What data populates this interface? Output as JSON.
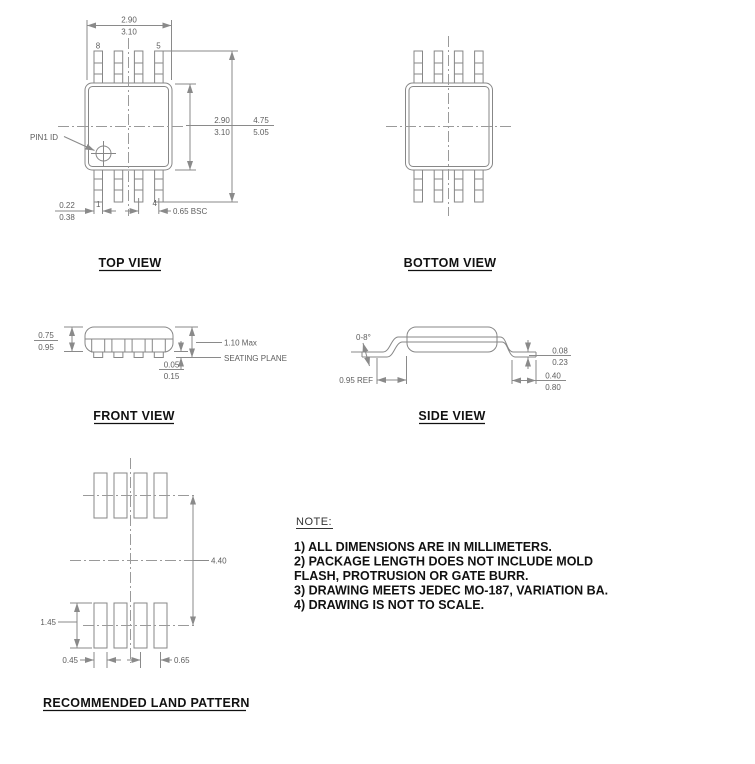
{
  "colors": {
    "line_gray": "#8a8a8a",
    "dim_text": "#5e5e5e",
    "ink": "#111111"
  },
  "top_view": {
    "title": "TOP VIEW",
    "pins": {
      "top_left": "8",
      "top_right": "5",
      "bottom_left": "1",
      "bottom_right": "4"
    },
    "pin1_id": "PIN1 ID",
    "width": {
      "upper": "2.90",
      "lower": "3.10"
    },
    "body_height": {
      "upper": "2.90",
      "lower": "3.10"
    },
    "overall_height": {
      "upper": "4.75",
      "lower": "5.05"
    },
    "lead_width": {
      "upper": "0.22",
      "lower": "0.38"
    },
    "pitch": "0.65 BSC"
  },
  "bottom_view": {
    "title": "BOTTOM VIEW"
  },
  "front_view": {
    "title": "FRONT VIEW",
    "thickness": {
      "upper": "0.75",
      "lower": "0.95"
    },
    "max_height": "1.10 Max",
    "seating_plane": "SEATING PLANE",
    "standoff": {
      "upper": "0.05",
      "lower": "0.15"
    }
  },
  "side_view": {
    "title": "SIDE VIEW",
    "lead_angle": "0-8°",
    "lead_thickness": {
      "upper": "0.08",
      "lower": "0.23"
    },
    "lead_length_ref": "0.95 REF",
    "foot_length": {
      "upper": "0.40",
      "lower": "0.80"
    }
  },
  "land_pattern": {
    "title": "RECOMMENDED LAND PATTERN",
    "row_span": "4.40",
    "pad_length": "1.45",
    "pad_width": "0.45",
    "pad_pitch": "0.65"
  },
  "note": {
    "heading": "NOTE:",
    "lines": [
      "1) ALL DIMENSIONS ARE IN MILLIMETERS.",
      "2) PACKAGE LENGTH DOES NOT INCLUDE MOLD",
      "FLASH, PROTRUSION OR GATE BURR.",
      "3) DRAWING MEETS JEDEC MO-187, VARIATION BA.",
      "4) DRAWING IS NOT TO SCALE."
    ]
  }
}
